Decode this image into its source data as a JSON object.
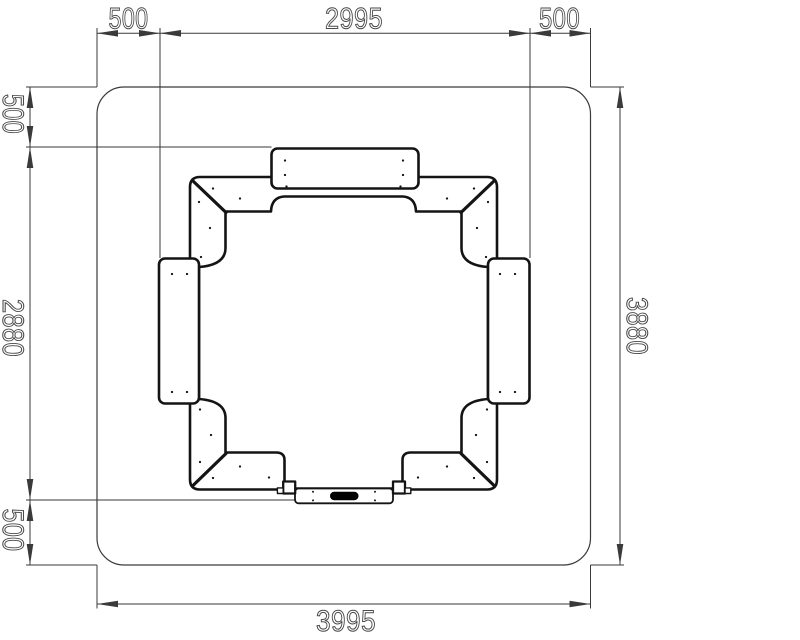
{
  "drawing": {
    "dims": {
      "top_left": "500",
      "top_center": "2995",
      "top_right": "500",
      "left_top": "500",
      "left_middle": "2880",
      "left_bottom": "500",
      "right_side": "3880",
      "bottom": "3995"
    },
    "colors": {
      "sheet": "#ffffff",
      "line": "#141414",
      "dim_line": "#3a3a3a",
      "dim_text": "#4a4a4a",
      "slot_fill": "#000000"
    }
  }
}
